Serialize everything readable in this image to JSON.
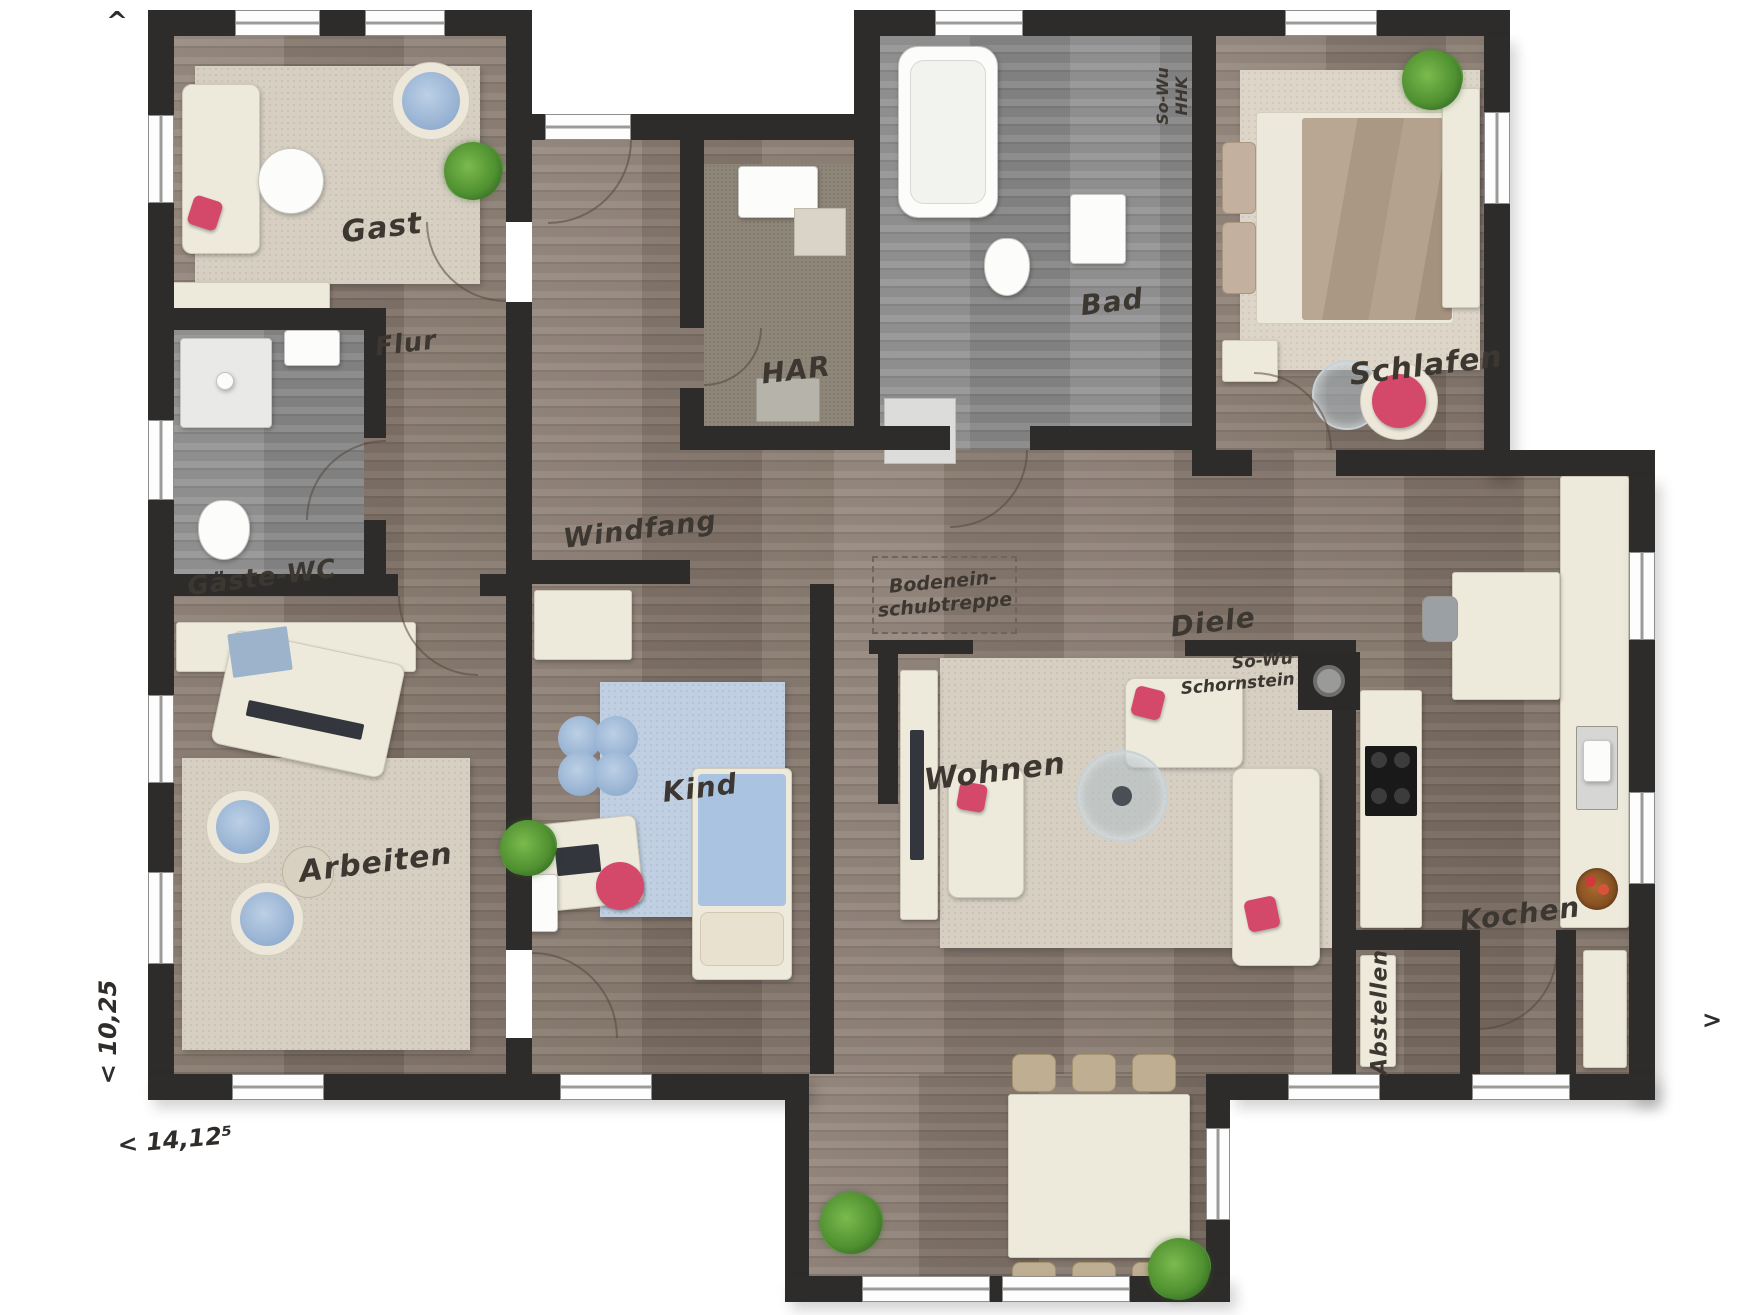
{
  "rooms": {
    "gast": "Gast",
    "flur": "Flur",
    "gaeste_wc": "Gäste-WC",
    "arbeiten": "Arbeiten",
    "windfang": "Windfang",
    "kind": "Kind",
    "har": "HAR",
    "bad": "Bad",
    "schlafen": "Schlafen",
    "diele": "Diele",
    "wohnen": "Wohnen",
    "kochen": "Kochen",
    "abstellen": "Abstellen"
  },
  "annotations": {
    "attic_hatch": {
      "line1": "Bodenein-",
      "line2": "schubtreppe"
    },
    "hhk": {
      "line1": "So-Wu",
      "line2": "HHK"
    },
    "chimney": {
      "line1": "So-Wu",
      "line2": "Schornstein"
    }
  },
  "dimensions": {
    "width": "< 14,12⁵",
    "depth": "< 10,25",
    "north": "^",
    "east": ">"
  },
  "colors": {
    "wall": "#2e2c2a",
    "wood": "#8a7a6e",
    "gray_wood": "#8f8f90",
    "carpet": "#8e8679",
    "cream": "#edeadc",
    "rug_beige": "#d6cfc2",
    "rug_blue": "#c0d0e2",
    "accent_red": "#d4496a",
    "blue": "#a6bedb",
    "plant_green": "#4f9030",
    "tan": "#bfae92"
  }
}
